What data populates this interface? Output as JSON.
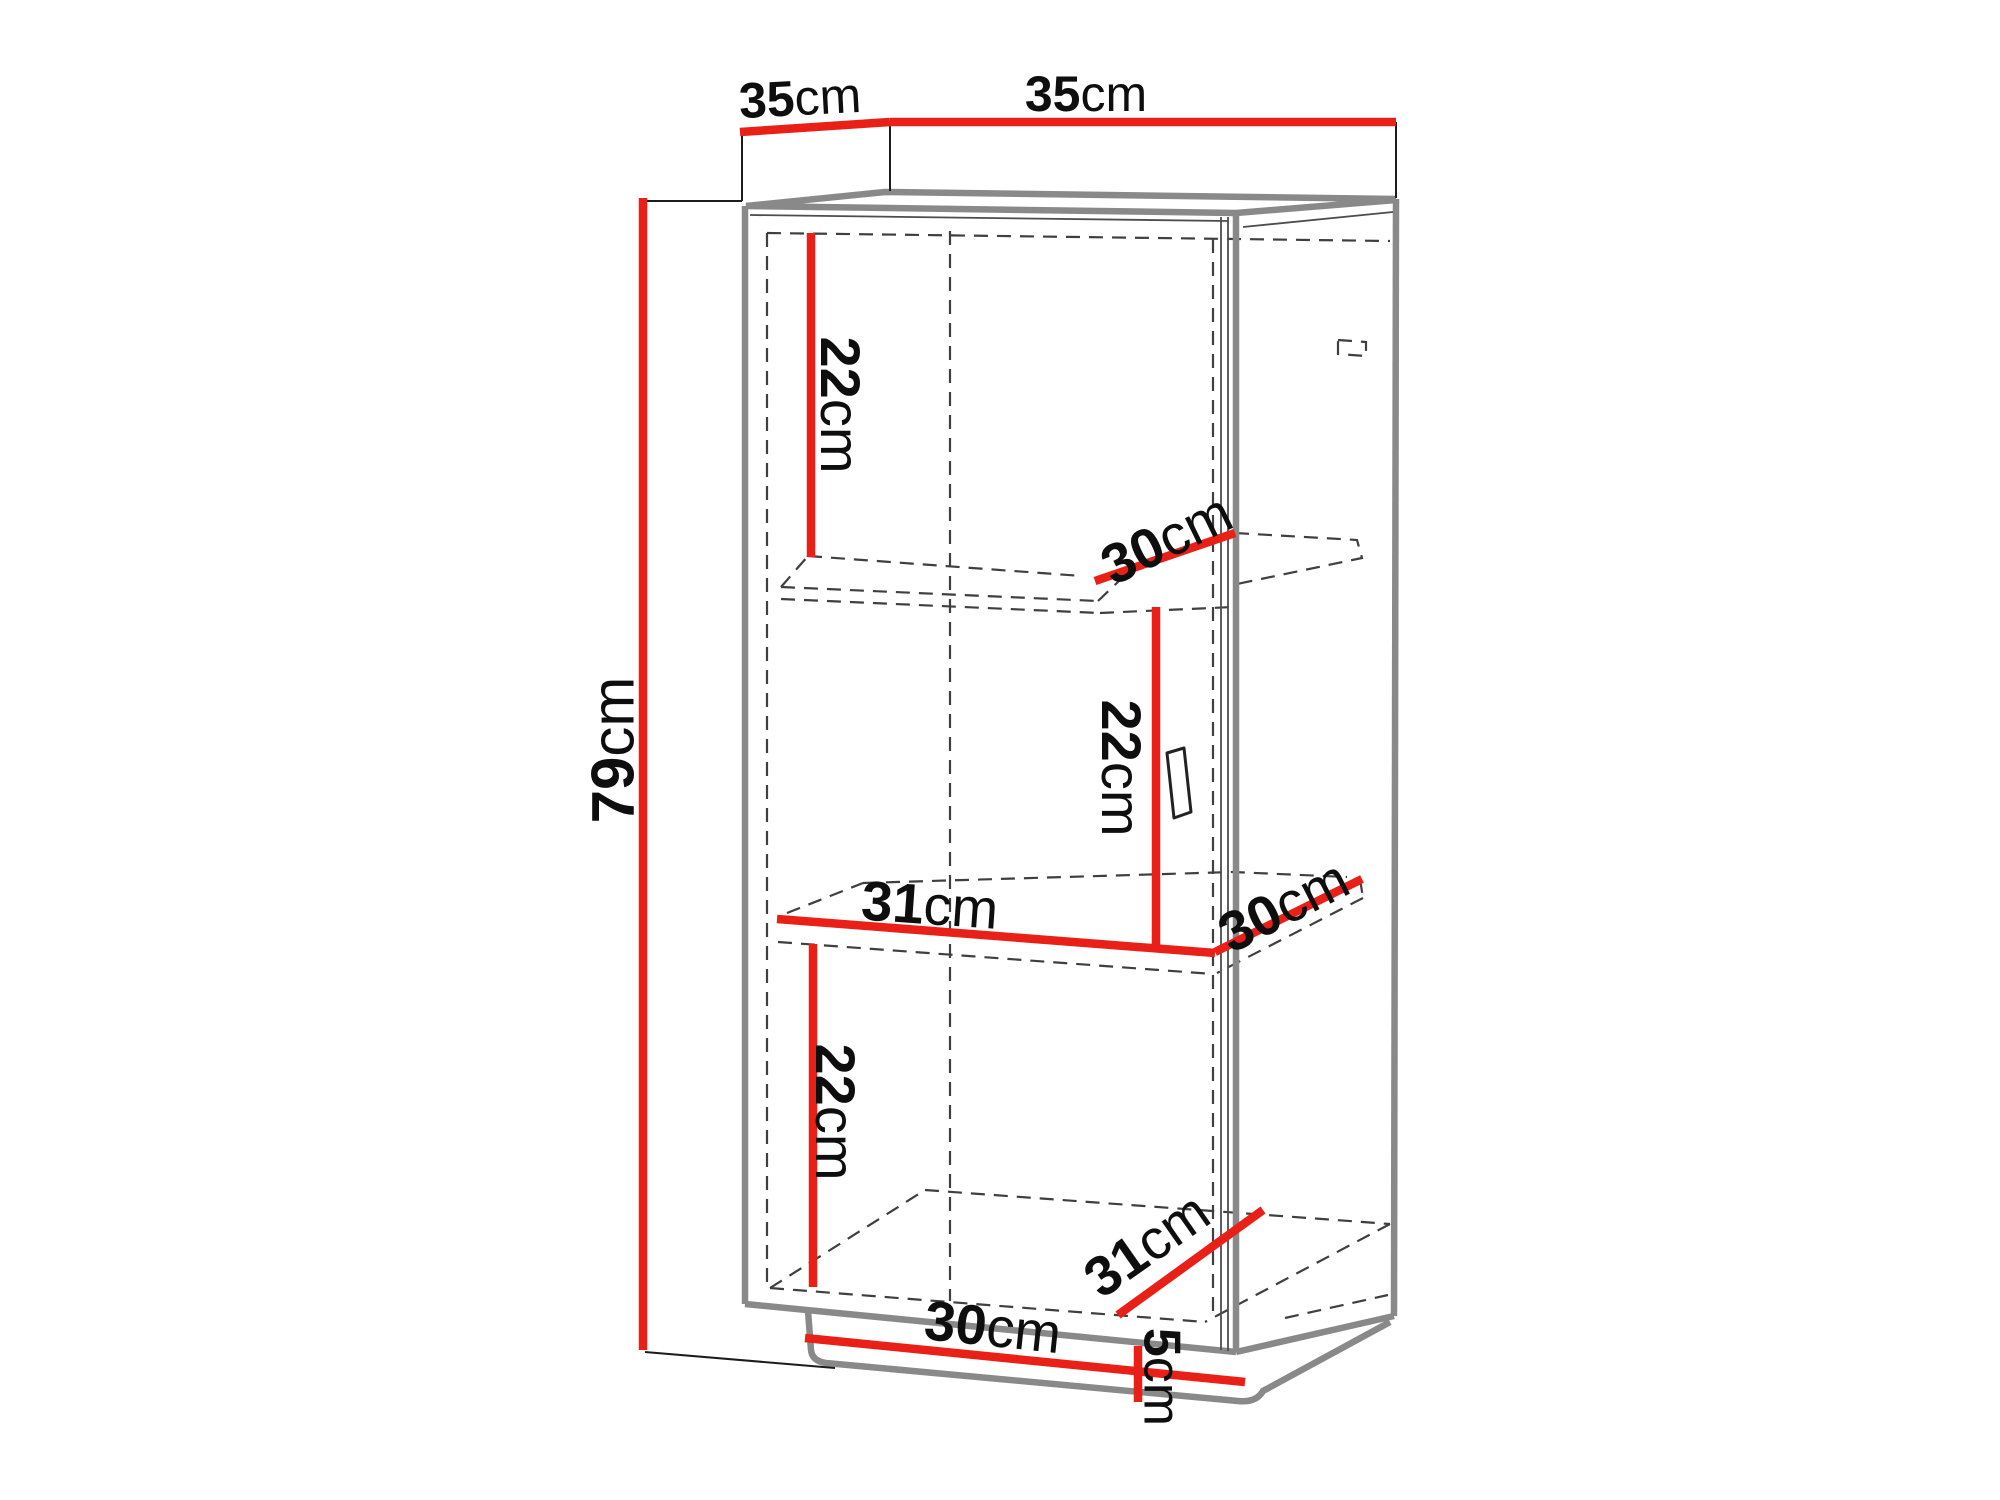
{
  "diagram": {
    "description": "Cabinet dimension diagram, 3D wireframe with red dimension lines",
    "canvas": {
      "width": 2000,
      "height": 1500
    },
    "colors": {
      "dimension_line": "#e82017",
      "cabinet_edge": "#898989",
      "thin_edge": "#4d4d4d",
      "hidden_edge": "#3f3f3f",
      "extension_line": "#1c1c1c",
      "label_text": "#0e0e0e",
      "background": "#ffffff",
      "handle_fill": "#ffffff",
      "handle_stroke": "#222222"
    },
    "labels": [
      {
        "id": "label-35cm-depth",
        "value": "35",
        "unit": "cm",
        "x": 800,
        "y": 97,
        "rotate": -3,
        "size": 50
      },
      {
        "id": "label-35cm-width",
        "value": "35",
        "unit": "cm",
        "x": 1086,
        "y": 93,
        "rotate": 0,
        "size": 50
      },
      {
        "id": "label-79cm-height",
        "value": "79",
        "unit": "cm",
        "x": 612,
        "y": 750,
        "rotate": -90,
        "size": 60
      },
      {
        "id": "label-22cm-top",
        "value": "22",
        "unit": "cm",
        "x": 841,
        "y": 405,
        "rotate": 90,
        "size": 56
      },
      {
        "id": "label-30cm-shelf1",
        "value": "30",
        "unit": "cm",
        "x": 1166,
        "y": 538,
        "rotate": -26,
        "size": 56
      },
      {
        "id": "label-22cm-middle",
        "value": "22",
        "unit": "cm",
        "x": 1122,
        "y": 768,
        "rotate": 90,
        "size": 56
      },
      {
        "id": "label-31cm-shelf2",
        "value": "31",
        "unit": "cm",
        "x": 930,
        "y": 904,
        "rotate": 4,
        "size": 56
      },
      {
        "id": "label-30cm-shelf2",
        "value": "30",
        "unit": "cm",
        "x": 1283,
        "y": 905,
        "rotate": -27,
        "size": 56
      },
      {
        "id": "label-22cm-bottom",
        "value": "22",
        "unit": "cm",
        "x": 836,
        "y": 1112,
        "rotate": 90,
        "size": 56
      },
      {
        "id": "label-30cm-bottom",
        "value": "30",
        "unit": "cm",
        "x": 993,
        "y": 1326,
        "rotate": 6,
        "size": 56
      },
      {
        "id": "label-31cm-bottom",
        "value": "31",
        "unit": "cm",
        "x": 1146,
        "y": 1244,
        "rotate": -35,
        "size": 56
      },
      {
        "id": "label-5cm-plinth",
        "value": "5",
        "unit": "cm",
        "x": 1163,
        "y": 1377,
        "rotate": 90,
        "size": 52
      }
    ],
    "dimension_lines": [
      {
        "id": "dim-35-depth",
        "x1": 740,
        "y1": 132,
        "x2": 890,
        "y2": 122
      },
      {
        "id": "dim-35-width",
        "x1": 890,
        "y1": 122,
        "x2": 1396,
        "y2": 122
      },
      {
        "id": "dim-79-height",
        "x1": 643,
        "y1": 198,
        "x2": 643,
        "y2": 1350
      },
      {
        "id": "dim-22-top",
        "x1": 811,
        "y1": 233,
        "x2": 811,
        "y2": 557
      },
      {
        "id": "dim-30-shelf1",
        "x1": 1095,
        "y1": 581,
        "x2": 1235,
        "y2": 533
      },
      {
        "id": "dim-22-middle",
        "x1": 1156,
        "y1": 607,
        "x2": 1156,
        "y2": 947
      },
      {
        "id": "dim-31-shelf2",
        "x1": 777,
        "y1": 919,
        "x2": 1215,
        "y2": 953
      },
      {
        "id": "dim-30-shelf2",
        "x1": 1215,
        "y1": 952,
        "x2": 1362,
        "y2": 879
      },
      {
        "id": "dim-22-bottom",
        "x1": 813,
        "y1": 944,
        "x2": 813,
        "y2": 1287
      },
      {
        "id": "dim-30-bottom",
        "x1": 805,
        "y1": 1338,
        "x2": 1245,
        "y2": 1382
      },
      {
        "id": "dim-31-bottom",
        "x1": 1118,
        "y1": 1315,
        "x2": 1263,
        "y2": 1210
      },
      {
        "id": "dim-5-plinth",
        "x1": 1138,
        "y1": 1346,
        "x2": 1138,
        "y2": 1402
      }
    ],
    "extension_lines": [
      {
        "id": "ext-79-top",
        "x1": 643,
        "y1": 201,
        "x2": 742,
        "y2": 201
      },
      {
        "id": "ext-35-left",
        "x1": 742,
        "y1": 132,
        "x2": 742,
        "y2": 201
      },
      {
        "id": "ext-35-mid",
        "x1": 890,
        "y1": 122,
        "x2": 890,
        "y2": 191
      },
      {
        "id": "ext-35-right",
        "x1": 1396,
        "y1": 122,
        "x2": 1396,
        "y2": 198
      },
      {
        "id": "ext-79-bottom",
        "x1": 645,
        "y1": 1352,
        "x2": 835,
        "y2": 1368
      }
    ],
    "cabinet_solid_paths": [
      {
        "id": "top-back-edge",
        "d": "M 746,206 L 885,192 L 1396,199"
      },
      {
        "id": "top-front-edge",
        "d": "M 746,206 L 1236,213 L 1396,200"
      },
      {
        "id": "front-left-edge",
        "d": "M 745,206 L 745,1304"
      },
      {
        "id": "front-right-post",
        "d": "M 1236,213 L 1236,1352"
      },
      {
        "id": "back-right-edge",
        "d": "M 1396,199 L 1394,1316"
      },
      {
        "id": "bottom-front-edge",
        "d": "M 745,1304 L 1236,1352"
      },
      {
        "id": "side-bottom-edge",
        "d": "M 1394,1316 L 1236,1352"
      },
      {
        "id": "plinth-outline",
        "d": "M 808,1311 L 811,1350 Q 812,1361 826,1363 L 1238,1401 Q 1256,1403 1263,1391 L 1390,1322"
      }
    ],
    "cabinet_thin_paths": [
      {
        "id": "top-rail-line",
        "d": "M 750,215 L 1228,221"
      },
      {
        "id": "side-top-line",
        "d": "M 1243,227 L 1393,212"
      },
      {
        "id": "door-edge-line-1",
        "d": "M 1221,217 L 1221,1350"
      },
      {
        "id": "door-edge-line-2",
        "d": "M 1228,217 L 1228,1351"
      }
    ],
    "hidden_dashed_paths": [
      {
        "id": "interior-top-edge",
        "d": "M 767,233 L 1390,241"
      },
      {
        "id": "door-left-edge",
        "d": "M 767,233 L 767,1289"
      },
      {
        "id": "interior-center-line",
        "d": "M 950,231 L 950,1301"
      },
      {
        "id": "door-right-edge",
        "d": "M 1213,239 L 1213,1320"
      },
      {
        "id": "corner-detail",
        "d": "M 1338,340 L 1366,342 L 1366,356 L 1338,354 Z"
      },
      {
        "id": "shelf1-left-edge",
        "d": "M 781,587 L 808,556"
      },
      {
        "id": "shelf1-back-edge",
        "d": "M 808,556 L 1082,576"
      },
      {
        "id": "shelf1-front-top-edge",
        "d": "M 781,587 L 1098,601"
      },
      {
        "id": "shelf1-right-corner",
        "d": "M 1098,601 L 1120,580"
      },
      {
        "id": "shelf1-front-bottom",
        "d": "M 781,599 L 1100,613"
      },
      {
        "id": "shelf1-bottom-right",
        "d": "M 1100,613 L 1233,607"
      },
      {
        "id": "shelf1-right-part",
        "d": "M 1235,533 L 1357,540 L 1362,558 L 1237,584"
      },
      {
        "id": "shelf2-left-edge",
        "d": "M 787,913 L 863,883"
      },
      {
        "id": "shelf2-back-edge",
        "d": "M 863,883 L 1233,872 L 1347,877"
      },
      {
        "id": "shelf2-front-bottom",
        "d": "M 778,942 L 1213,974"
      },
      {
        "id": "shelf2-right-tick",
        "d": "M 1360,879 L 1363,898"
      },
      {
        "id": "shelf2-right-return",
        "d": "M 1363,898 L 1217,973"
      },
      {
        "id": "floor-front-edge",
        "d": "M 770,1288 L 1205,1322"
      },
      {
        "id": "floor-left-edge",
        "d": "M 770,1288 L 925,1190"
      },
      {
        "id": "floor-back-edge",
        "d": "M 925,1190 L 1390,1224"
      },
      {
        "id": "floor-right-edge",
        "d": "M 1390,1224 L 1205,1322"
      },
      {
        "id": "plinth-back-detail",
        "d": "M 1285,1318 L 1388,1295"
      }
    ],
    "handle": {
      "id": "door-handle",
      "points": "1167,753 1184,748 1191,812 1174,818"
    }
  }
}
